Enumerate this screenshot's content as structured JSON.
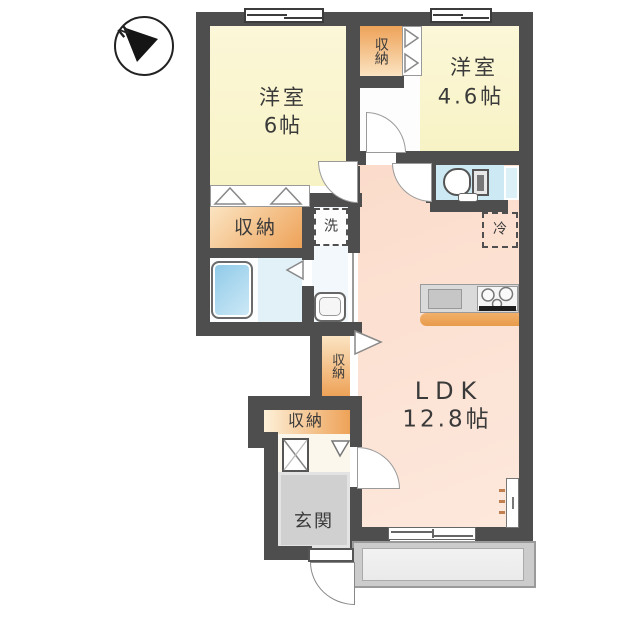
{
  "compass": {
    "north_label": "N"
  },
  "rooms": {
    "bedroom1": {
      "name": "洋室",
      "size": "6帖"
    },
    "bedroom2": {
      "name": "洋室",
      "size": "4.6帖"
    },
    "ldk": {
      "name": "LDK",
      "size": "12.8帖"
    },
    "entrance": {
      "label": "玄関"
    }
  },
  "storage": {
    "closet_top": "収納",
    "closet_mid": "収納",
    "closet_vertical": "収納",
    "closet_hall": "収納"
  },
  "fixtures": {
    "washing_machine": "洗",
    "refrigerator": "冷"
  },
  "colors": {
    "wall": "#4e4e4e",
    "room-yellow": "#f8f3c5",
    "room-yellow2": "#fbf7d8",
    "ldk-pink": "#fbdccb",
    "ldk-pink2": "#fde8dc",
    "closet-orange": "#eea258",
    "closet-light": "#fbe4c2",
    "bath-blue": "#e2f0f8",
    "toilet-blue": "#cde9f3",
    "tub-blue": "#8ec9e8",
    "tub-blue2": "#cfeaf7",
    "wash-floor": "#f2f8fb",
    "genkan-gray": "#d0d0d0",
    "balcony-gray": "#cccccc",
    "balcony-inner": "#eaeaea",
    "counter-orange": "#efa85e",
    "hall-cream": "#fcf7ec"
  }
}
